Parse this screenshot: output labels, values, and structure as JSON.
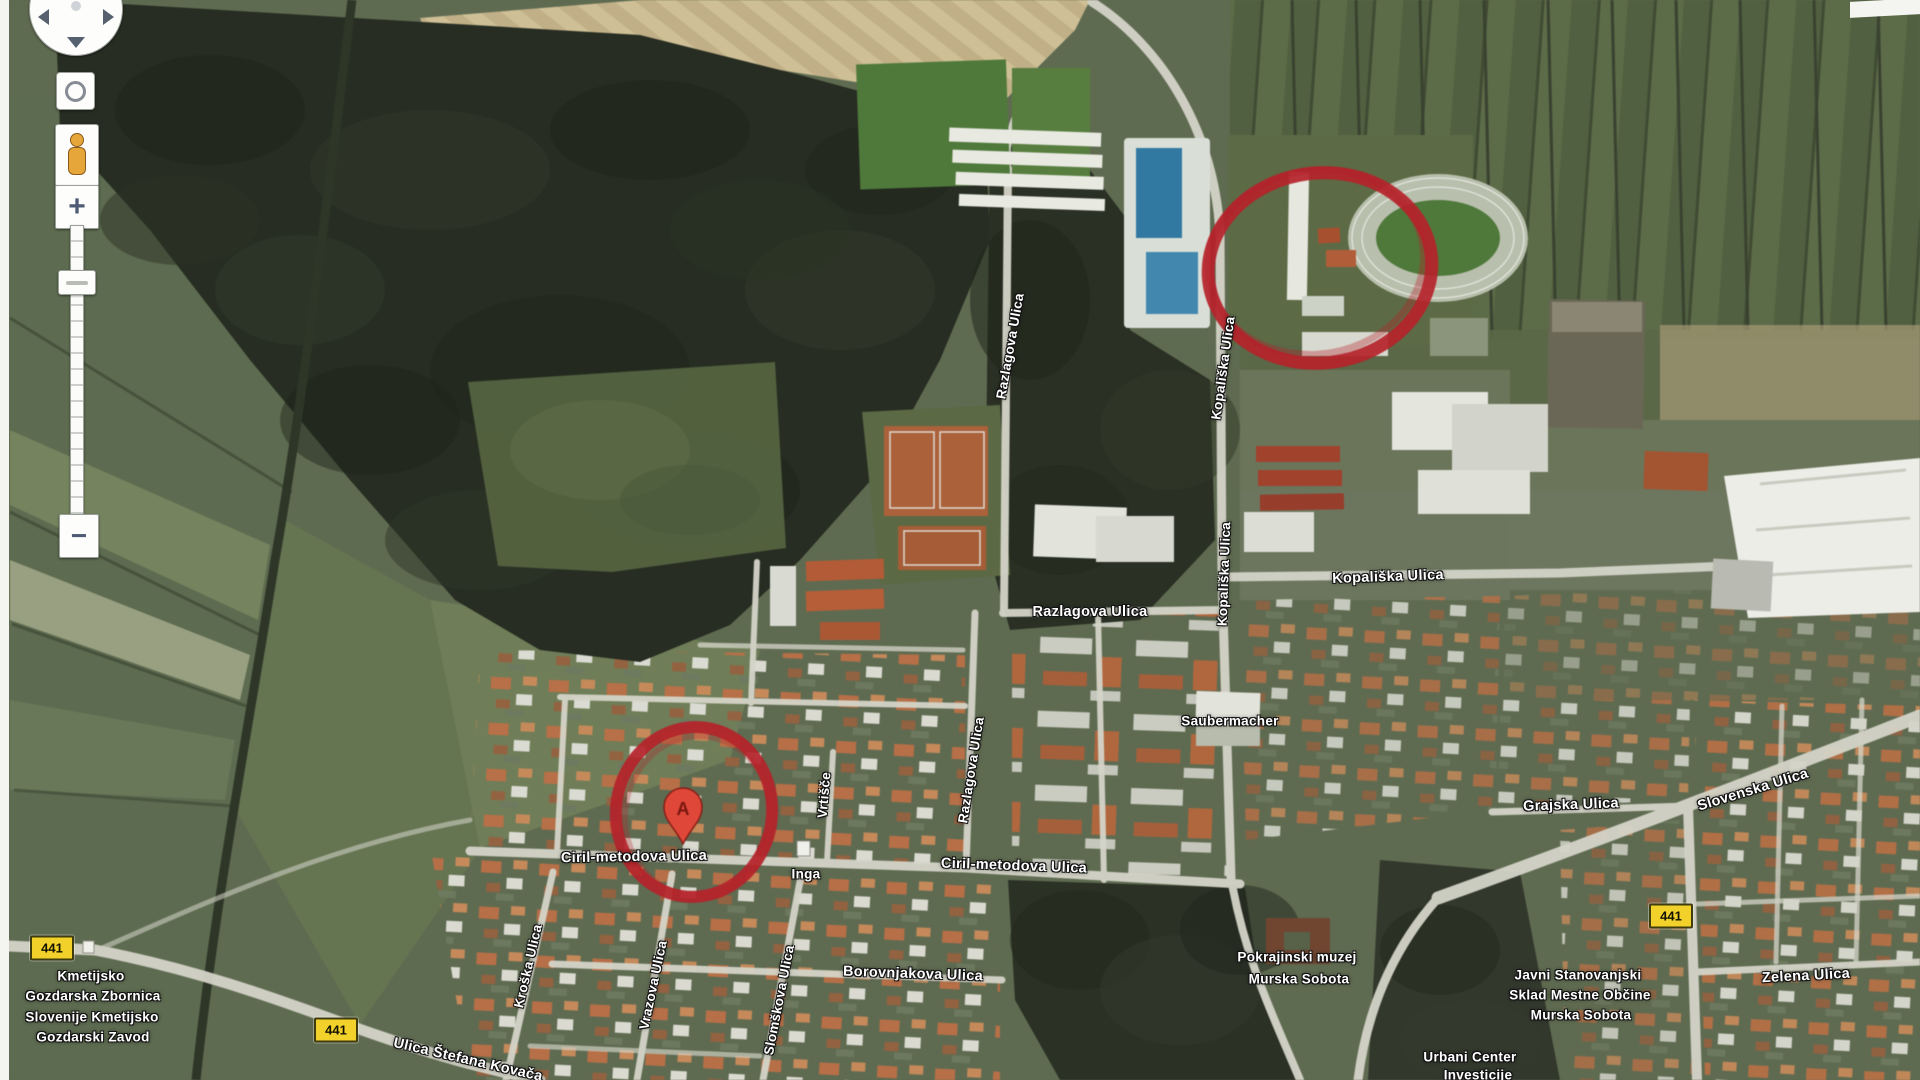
{
  "map": {
    "marker_label": "A",
    "route_badges": [
      "441",
      "441",
      "441"
    ],
    "labels": [
      {
        "id": "razlagova-vertical-north",
        "text": "Razlagova Ulica"
      },
      {
        "id": "kopaliska-vertical-north",
        "text": "Kopališka Ulica"
      },
      {
        "id": "kopaliska-vertical-south",
        "text": "Kopališka Ulica"
      },
      {
        "id": "kopaliska-horizontal",
        "text": "Kopališka Ulica"
      },
      {
        "id": "razlagova-horizontal",
        "text": "Razlagova Ulica"
      },
      {
        "id": "saubermacher",
        "text": "Saubermacher"
      },
      {
        "id": "razlagova-vertical-south",
        "text": "Razlagova Ulica"
      },
      {
        "id": "vrtisce",
        "text": "Vrtišče"
      },
      {
        "id": "ciril-metodova-west",
        "text": "Ciril-metodova Ulica"
      },
      {
        "id": "inga",
        "text": "Inga"
      },
      {
        "id": "ciril-metodova-east",
        "text": "Ciril-metodova Ulica"
      },
      {
        "id": "borovnjakova",
        "text": "Borovnjakova Ulica"
      },
      {
        "id": "kroska",
        "text": "Kroška Ulica"
      },
      {
        "id": "vrazova",
        "text": "Vrazova Ulica"
      },
      {
        "id": "slomskova",
        "text": "Slomškova Ulica"
      },
      {
        "id": "kmetijsko-line1",
        "text": "Kmetijsko"
      },
      {
        "id": "kmetijsko-line2",
        "text": "Gozdarska Zbornica"
      },
      {
        "id": "kmetijsko-line3",
        "text": "Slovenije Kmetijsko"
      },
      {
        "id": "kmetijsko-line4",
        "text": "Gozdarski Zavod"
      },
      {
        "id": "ulica-stefana-kovaca",
        "text": "Ulica Štefana Kovača"
      },
      {
        "id": "pokrajinski-line1",
        "text": "Pokrajinski muzej"
      },
      {
        "id": "pokrajinski-line2",
        "text": "Murska Sobota"
      },
      {
        "id": "grajska",
        "text": "Grajska Ulica"
      },
      {
        "id": "slovenska",
        "text": "Slovenska Ulica"
      },
      {
        "id": "javni-line1",
        "text": "Javni Stanovanjski"
      },
      {
        "id": "javni-line2",
        "text": "Sklad Mestne Občine"
      },
      {
        "id": "javni-line3",
        "text": "Murska Sobota"
      },
      {
        "id": "zelena",
        "text": "Zelena Ulica"
      },
      {
        "id": "urbani-line1",
        "text": "Urbani Center"
      },
      {
        "id": "urbani-line2",
        "text": "Investicije"
      }
    ]
  },
  "controls": {
    "zoom_in": "+",
    "zoom_out": "−"
  },
  "annotation_color": "#bf2028"
}
